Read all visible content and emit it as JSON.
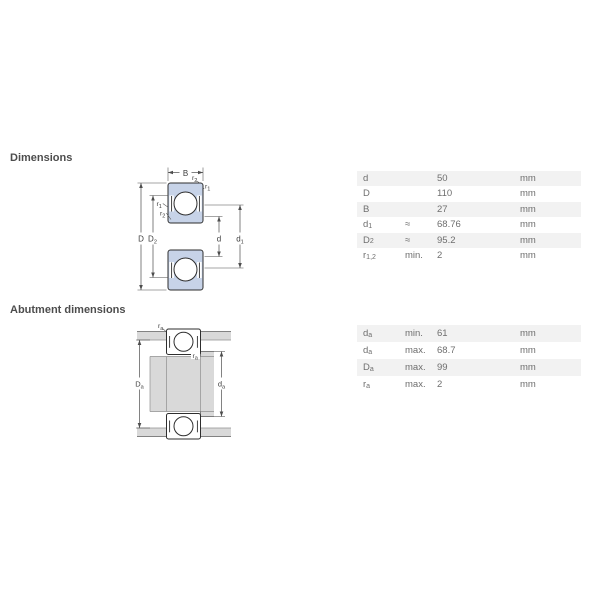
{
  "headings": {
    "dimensions": "Dimensions",
    "abutment": "Abutment dimensions"
  },
  "colors": {
    "page_bg": "#ffffff",
    "ring_fill": "#c7d3e8",
    "outline": "#2e2e2e",
    "metal": "#d9d9d9",
    "dim_line": "#4d4d4d",
    "label_text": "#3c3c3c",
    "row_alt": "#f2f2f2",
    "table_text": "#6e6e6e",
    "heading_text": "#4d4d4d"
  },
  "dimensions_table": {
    "rows": [
      {
        "symbol": "d",
        "sub": "",
        "qualifier": "",
        "value": "50",
        "unit": "mm"
      },
      {
        "symbol": "D",
        "sub": "",
        "qualifier": "",
        "value": "110",
        "unit": "mm"
      },
      {
        "symbol": "B",
        "sub": "",
        "qualifier": "",
        "value": "27",
        "unit": "mm"
      },
      {
        "symbol": "d",
        "sub": "1",
        "qualifier": "≈",
        "value": "68.76",
        "unit": "mm"
      },
      {
        "symbol": "D",
        "sub": "2",
        "qualifier": "≈",
        "value": "95.2",
        "unit": "mm"
      },
      {
        "symbol": "r",
        "sub": "1,2",
        "qualifier": "min.",
        "value": "2",
        "unit": "mm"
      }
    ]
  },
  "abutment_table": {
    "rows": [
      {
        "symbol": "d",
        "sub": "a",
        "qualifier": "min.",
        "value": "61",
        "unit": "mm"
      },
      {
        "symbol": "d",
        "sub": "a",
        "qualifier": "max.",
        "value": "68.7",
        "unit": "mm"
      },
      {
        "symbol": "D",
        "sub": "a",
        "qualifier": "max.",
        "value": "99",
        "unit": "mm"
      },
      {
        "symbol": "r",
        "sub": "a",
        "qualifier": "max.",
        "value": "2",
        "unit": "mm"
      }
    ]
  },
  "diagram1": {
    "labels": {
      "B": "B",
      "D": "D",
      "D2_base": "D",
      "D2_sub": "2",
      "d": "d",
      "d1_base": "d",
      "d1_sub": "1",
      "r1_base": "r",
      "r1_sub": "1",
      "r2_base": "r",
      "r2_sub": "2"
    }
  },
  "diagram2": {
    "labels": {
      "ra_base": "r",
      "ra_sub": "a",
      "Da_base": "D",
      "Da_sub": "a",
      "da_base": "d",
      "da_sub": "a"
    }
  }
}
